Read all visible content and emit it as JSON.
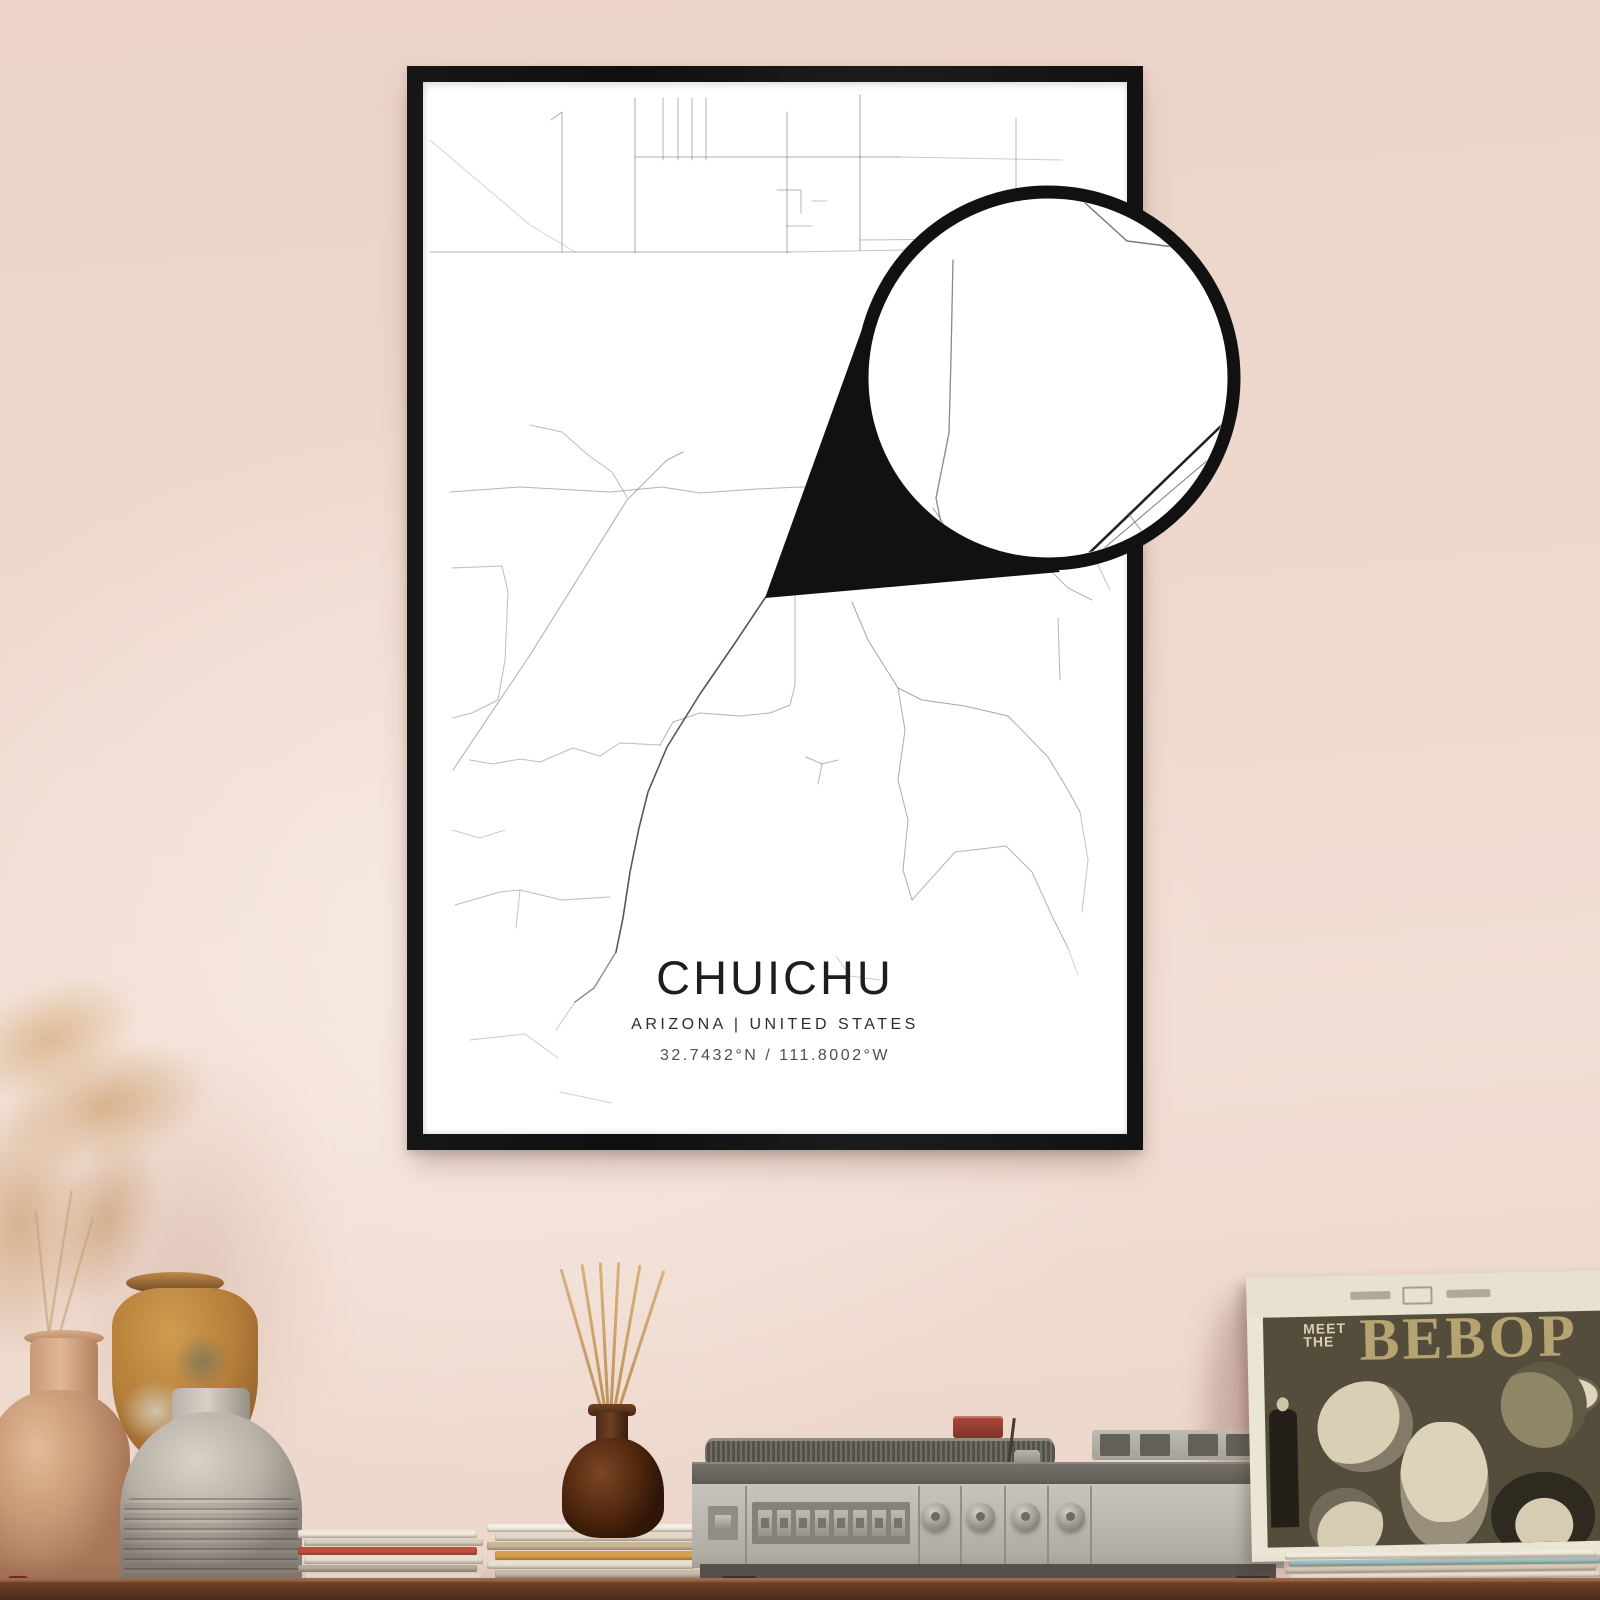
{
  "poster": {
    "title": "CHUICHU",
    "subtitle": "ARIZONA | UNITED STATES",
    "coordinates": "32.7432°N / 111.8002°W",
    "frame_color": "#151515",
    "paper_color": "#ffffff"
  },
  "wall": {
    "base_color": "#eed7cc",
    "highlight_color": "#f5e6dd"
  },
  "shelf": {
    "wood_color": "#6f4027"
  },
  "album": {
    "meet": "MEET",
    "the": "THE",
    "title": "BEBOP"
  },
  "map": {
    "road_color": "#6a6a6a",
    "roads": [
      {
        "pts": "430,140 530,225 575,252",
        "o": 0.3
      },
      {
        "pts": "551,120 562,112 562,252",
        "o": 0.55
      },
      {
        "pts": "635,98 635,253",
        "o": 0.55
      },
      {
        "pts": "663,98 663,160",
        "o": 0.5
      },
      {
        "pts": "678,98 678,160",
        "o": 0.5
      },
      {
        "pts": "692,98 692,160",
        "o": 0.5
      },
      {
        "pts": "706,98 706,160",
        "o": 0.5
      },
      {
        "pts": "787,112 787,253",
        "o": 0.55
      },
      {
        "pts": "860,95 860,250",
        "o": 0.6
      },
      {
        "pts": "635,157 900,157",
        "o": 0.55
      },
      {
        "pts": "900,157 1062,160",
        "o": 0.35
      },
      {
        "pts": "430,252 790,252",
        "o": 0.5
      },
      {
        "pts": "790,252 906,250",
        "o": 0.4
      },
      {
        "pts": "1016,118 1016,240",
        "o": 0.5
      },
      {
        "pts": "860,240 1062,238",
        "o": 0.45
      },
      {
        "pts": "777,190 801,190 801,213",
        "o": 0.5
      },
      {
        "pts": "786,226 812,226",
        "o": 0.45
      },
      {
        "pts": "812,201 827,201",
        "o": 0.4
      },
      {
        "pts": "450,492 520,487 610,492 662,487 700,493 757,489 800,487 880,489",
        "o": 0.5
      },
      {
        "pts": "453,770 530,655 627,500 667,460 683,452",
        "o": 0.55
      },
      {
        "pts": "530,425 562,432 588,455 612,472 627,497",
        "o": 0.45
      },
      {
        "pts": "795,517 795,685 790,705 770,713 740,716 700,713 673,722 660,745",
        "o": 0.5
      },
      {
        "pts": "660,745 620,743 600,756 573,748 540,762 520,759 493,764 470,760",
        "o": 0.45
      },
      {
        "pts": "452,568 502,566 508,592 505,660 498,700 472,713 452,718",
        "o": 0.45
      },
      {
        "pts": "452,830 480,838 505,830",
        "o": 0.35
      },
      {
        "pts": "455,905 500,892 520,890 562,900 610,897",
        "o": 0.45
      },
      {
        "pts": "520,890 516,928",
        "o": 0.4
      },
      {
        "pts": "470,1040 525,1034 558,1058",
        "o": 0.35
      },
      {
        "pts": "560,1092 612,1103",
        "o": 0.3
      },
      {
        "pts": "830,537 800,560 765,598 735,643 700,694 667,747 648,792 639,828 630,872 623,918 616,952",
        "w": 1.6,
        "o": 0.9,
        "c": "#454545"
      },
      {
        "pts": "616,952 594,988 575,1002",
        "w": 1.4,
        "o": 0.6,
        "c": "#454545"
      },
      {
        "pts": "575,1002 556,1030",
        "w": 1.2,
        "o": 0.3
      },
      {
        "pts": "852,602 868,640 898,688",
        "o": 0.6
      },
      {
        "pts": "898,688 922,700 965,706 1008,716",
        "o": 0.6
      },
      {
        "pts": "1008,716 1048,757 1068,790 1080,812",
        "o": 0.55
      },
      {
        "pts": "1080,812 1088,860 1082,912",
        "o": 0.4
      },
      {
        "pts": "898,688 905,730 898,780 908,820 903,870 912,900",
        "o": 0.55
      },
      {
        "pts": "806,757 822,764 838,760",
        "o": 0.5
      },
      {
        "pts": "822,764 818,784",
        "o": 0.5
      },
      {
        "pts": "912,900 955,852 1006,846 1032,872 1053,918 1068,948",
        "o": 0.5
      },
      {
        "pts": "1068,948 1078,975",
        "o": 0.3
      },
      {
        "pts": "1058,618 1060,680",
        "o": 0.5
      },
      {
        "pts": "1040,560 1068,588 1092,600",
        "o": 0.5
      },
      {
        "pts": "836,956 850,976 880,980",
        "o": 0.35
      },
      {
        "pts": "1086,540 1110,590",
        "o": 0.4
      }
    ],
    "loupe": {
      "center_x": 1048,
      "center_y": 378,
      "radius": 186,
      "ring_color": "#111111",
      "roads": [
        {
          "pts": "953,260 951,358 949,433 936,498 945,543",
          "w": 1.3,
          "o": 0.8
        },
        {
          "pts": "1084,202 1127,241 1174,247 1216,256",
          "w": 1.5,
          "o": 0.9
        },
        {
          "pts": "1248,400 1053,588",
          "w": 2.6,
          "o": 1,
          "c": "#222222"
        },
        {
          "pts": "1243,430 1048,596",
          "w": 1.1,
          "o": 0.8
        },
        {
          "pts": "933,508 962,550",
          "w": 1.1,
          "o": 0.5
        },
        {
          "pts": "1128,513 1156,550",
          "w": 1.1,
          "o": 0.6
        }
      ]
    }
  },
  "turntable": {
    "preset_button_count": 8,
    "knob_positions": [
      936,
      981,
      1026,
      1071
    ],
    "groove_positions": [
      745,
      918,
      960,
      1004,
      1047,
      1090
    ],
    "slot_positions": [
      8,
      48,
      96,
      134
    ]
  },
  "magazines": {
    "left_colors": [
      "#efe9dd",
      "#d9d0c0",
      "#c24c3e",
      "#e8e0cf",
      "#b9b2a0",
      "#efe9dd"
    ],
    "center_colors": [
      "#f3ede2",
      "#e3d9c6",
      "#c8b89a",
      "#d5a04c",
      "#efe7d8",
      "#cfc6b4",
      "#f6f0e5"
    ],
    "album_under_colors": [
      "#f2ece0",
      "#9ec6c6",
      "#ddd3c0",
      "#f5efe2"
    ]
  },
  "diffuser": {
    "reed_angles": [
      -16,
      -9,
      -3,
      3,
      10,
      18
    ]
  }
}
